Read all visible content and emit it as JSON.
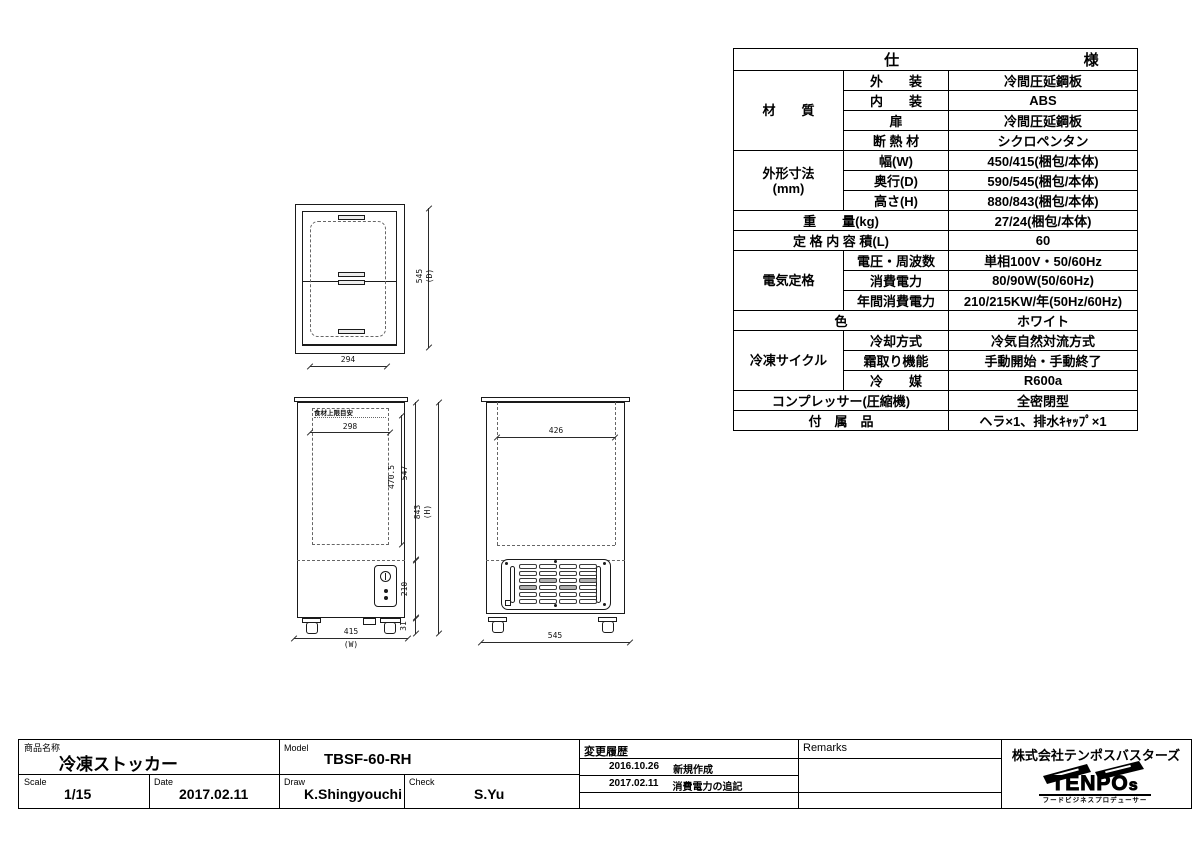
{
  "colors": {
    "line": "#1a1a1a",
    "background": "#ffffff"
  },
  "spec_table": {
    "header_left": "仕",
    "header_right": "様",
    "rows": [
      {
        "group": "材　　質",
        "rowspan": 4,
        "label": "外　　装",
        "value": "冷間圧延鋼板"
      },
      {
        "label": "内　　装",
        "value": "ABS"
      },
      {
        "label": "扉",
        "value": "冷間圧延鋼板"
      },
      {
        "label": "断 熱 材",
        "value": "シクロペンタン"
      },
      {
        "group": "外形寸法\n(mm)",
        "rowspan": 3,
        "label": "幅(W)",
        "value": "450/415(梱包/本体)"
      },
      {
        "label": "奥行(D)",
        "value": "590/545(梱包/本体)"
      },
      {
        "label": "高さ(H)",
        "value": "880/843(梱包/本体)"
      },
      {
        "merged_label": "重　　量(kg)",
        "value": "27/24(梱包/本体)"
      },
      {
        "merged_label": "定 格 内 容 積(L)",
        "value": "60"
      },
      {
        "group": "電気定格",
        "rowspan": 3,
        "label": "電圧・周波数",
        "value": "単相100V・50/60Hz"
      },
      {
        "label": "消費電力",
        "value": "80/90W(50/60Hz)"
      },
      {
        "label": "年間消費電力",
        "value": "210/215KW/年(50Hz/60Hz)"
      },
      {
        "merged_label": "色",
        "value": "ホワイト"
      },
      {
        "group": "冷凍サイクル",
        "rowspan": 3,
        "label": "冷却方式",
        "value": "冷気自然対流方式"
      },
      {
        "label": "霜取り機能",
        "value": "手動開始・手動終了"
      },
      {
        "label": "冷　　媒",
        "value": "R600a"
      },
      {
        "merged_label": "コンプレッサー(圧縮機)",
        "value": "全密閉型"
      },
      {
        "merged_label": "付　属　品",
        "value": "ヘラ×1、排水ｷｬｯﾌﾟ×1"
      }
    ]
  },
  "drawings": {
    "top_view": {
      "width_dim": "294",
      "depth_dim": "545",
      "depth_axis": "(D)"
    },
    "front_view": {
      "note": "食材上限目安",
      "inner_width_dim": "298",
      "inner_height_dim": "470.5",
      "door_height_dim": "547",
      "machine_height_dim": "210",
      "base_height_dim": "31",
      "total_height_dim": "843",
      "total_height_axis": "(H)",
      "width_dim": "415",
      "width_axis": "(W)"
    },
    "side_view": {
      "inner_width_dim": "426",
      "depth_dim": "545"
    }
  },
  "title_block": {
    "product_label": "商品名称",
    "product_name": "冷凍ストッカー",
    "model_label": "Model",
    "model_value": "TBSF-60-RH",
    "scale_label": "Scale",
    "scale_value": "1/15",
    "date_label": "Date",
    "date_value": "2017.02.11",
    "draw_label": "Draw",
    "draw_value": "K.Shingyouchi",
    "check_label": "Check",
    "check_value": "S.Yu",
    "history_label": "変更履歴",
    "history_rows": [
      {
        "date": "2016.10.26",
        "text": "新規作成"
      },
      {
        "date": "2017.02.11",
        "text": "消費電力の追記"
      }
    ],
    "remarks_label": "Remarks",
    "company_name": "株式会社テンポスバスターズ",
    "logo_word": "TENPO",
    "logo_word_small": "s",
    "logo_subtitle": "フードビジネスプロデューサー"
  }
}
